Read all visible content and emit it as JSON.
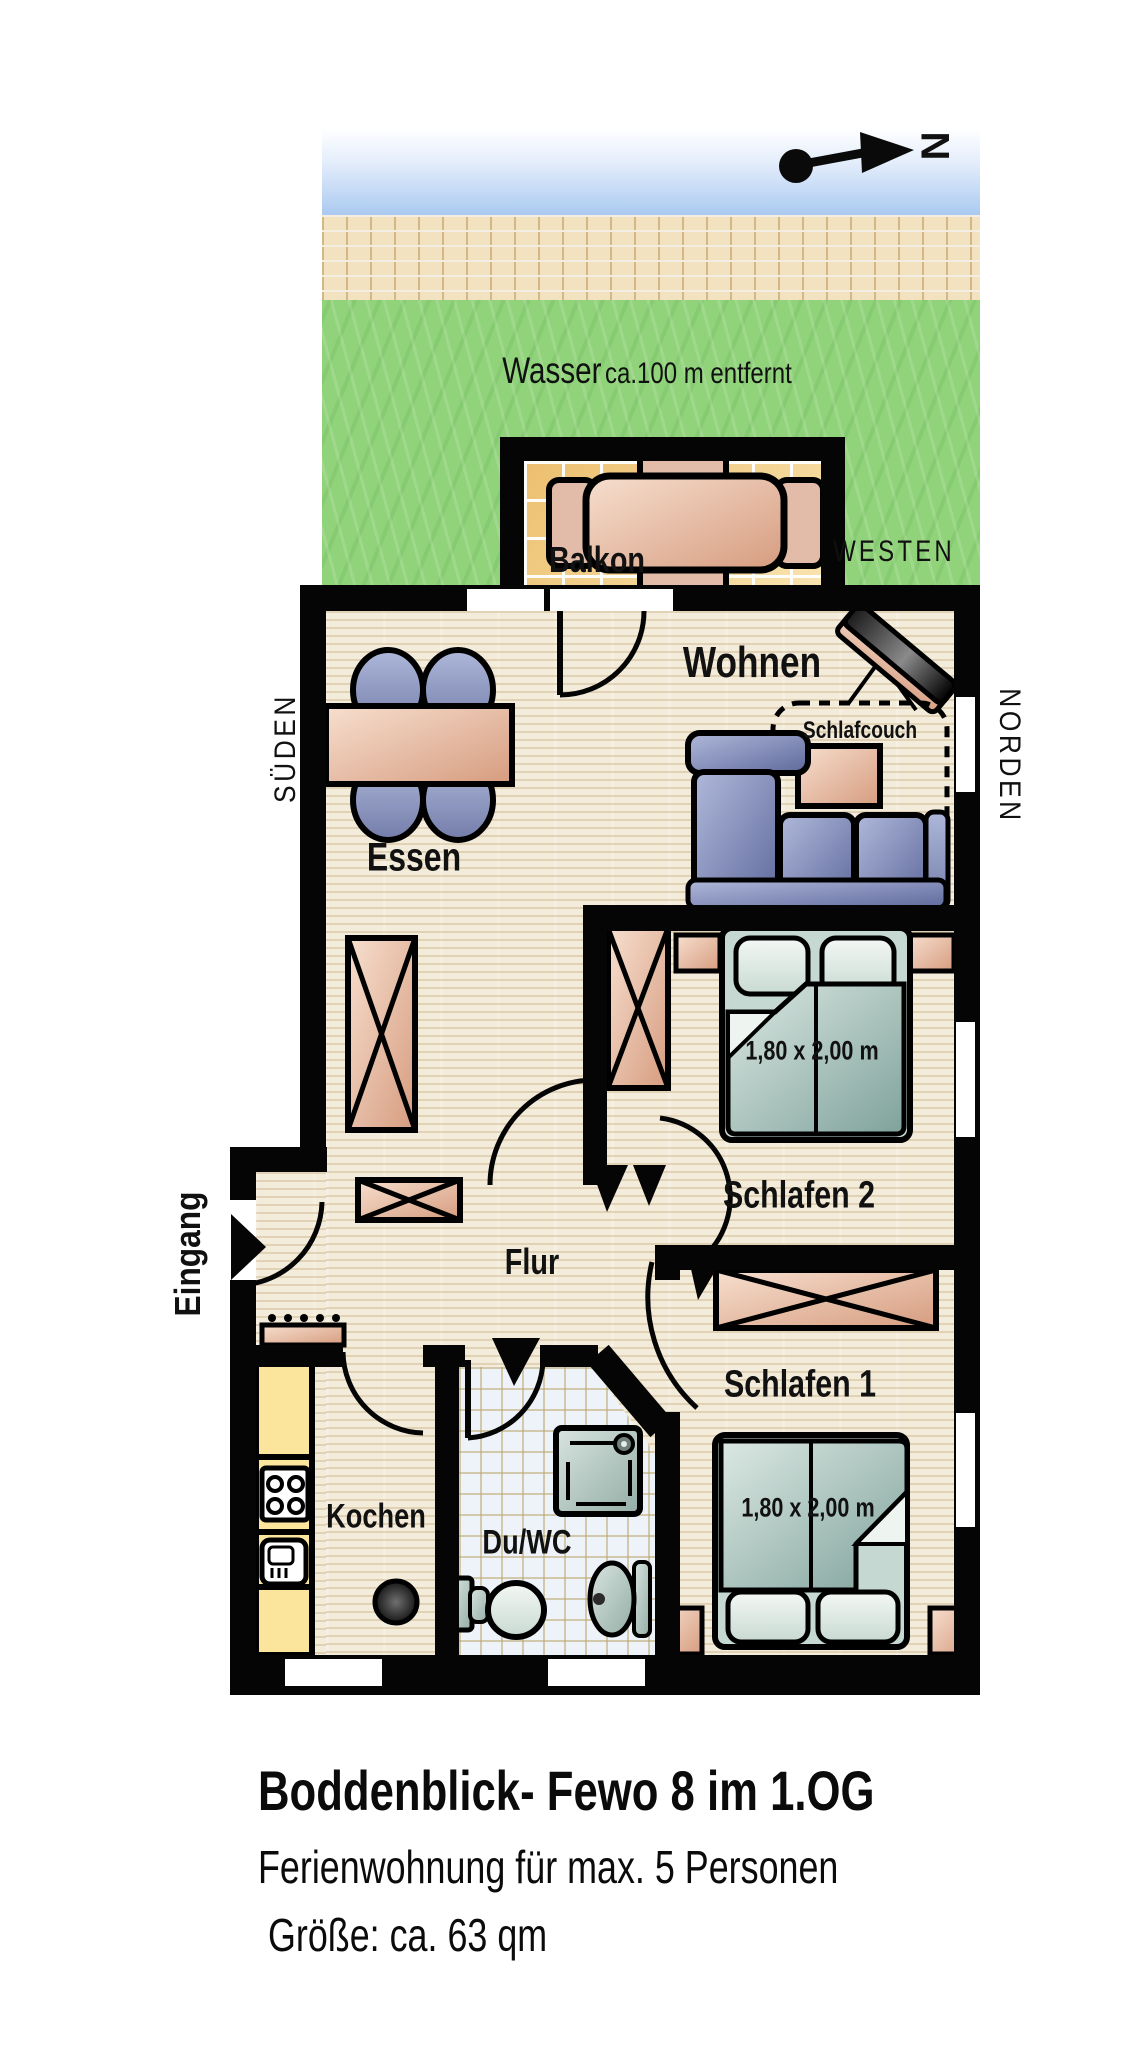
{
  "environment": {
    "water_word": "Wasser",
    "water_distance": "ca.100 m entfernt",
    "compass_north": "N"
  },
  "orientation": {
    "west": "WESTEN",
    "north": "NORDEN",
    "south": "SÜDEN",
    "entrance": "Eingang"
  },
  "rooms": {
    "balcony": "Balkon",
    "living": "Wohnen",
    "sleepcouch": "Schlafcouch",
    "dining": "Essen",
    "bedroom2": "Schlafen 2",
    "bedroom1": "Schlafen 1",
    "hall": "Flur",
    "kitchen": "Kochen",
    "bath": "Du/WC",
    "bed2_size": "1,80 x 2,00 m",
    "bed1_size": "1,80 x 2,00 m"
  },
  "caption": {
    "title": "Boddenblick- Fewo 8 im 1.OG",
    "line2": "Ferienwohnung für max. 5 Personen",
    "line3": "Größe: ca. 63 qm"
  },
  "palette": {
    "wall": "#050505",
    "water": "#a9c9f0",
    "sand": "#f3e2c0",
    "grass": "#90d37a",
    "floor": "#f4ecdb",
    "balcony_tile": "#f0cd84",
    "bath_tile": "#eef3f9",
    "counter_yellow": "#fbe49b",
    "furniture_pink": "#e0ac91",
    "chair_blue": "#8f99c4",
    "sofa_blue": "#7d86b5",
    "bed_teal": "#9fbcb6"
  }
}
